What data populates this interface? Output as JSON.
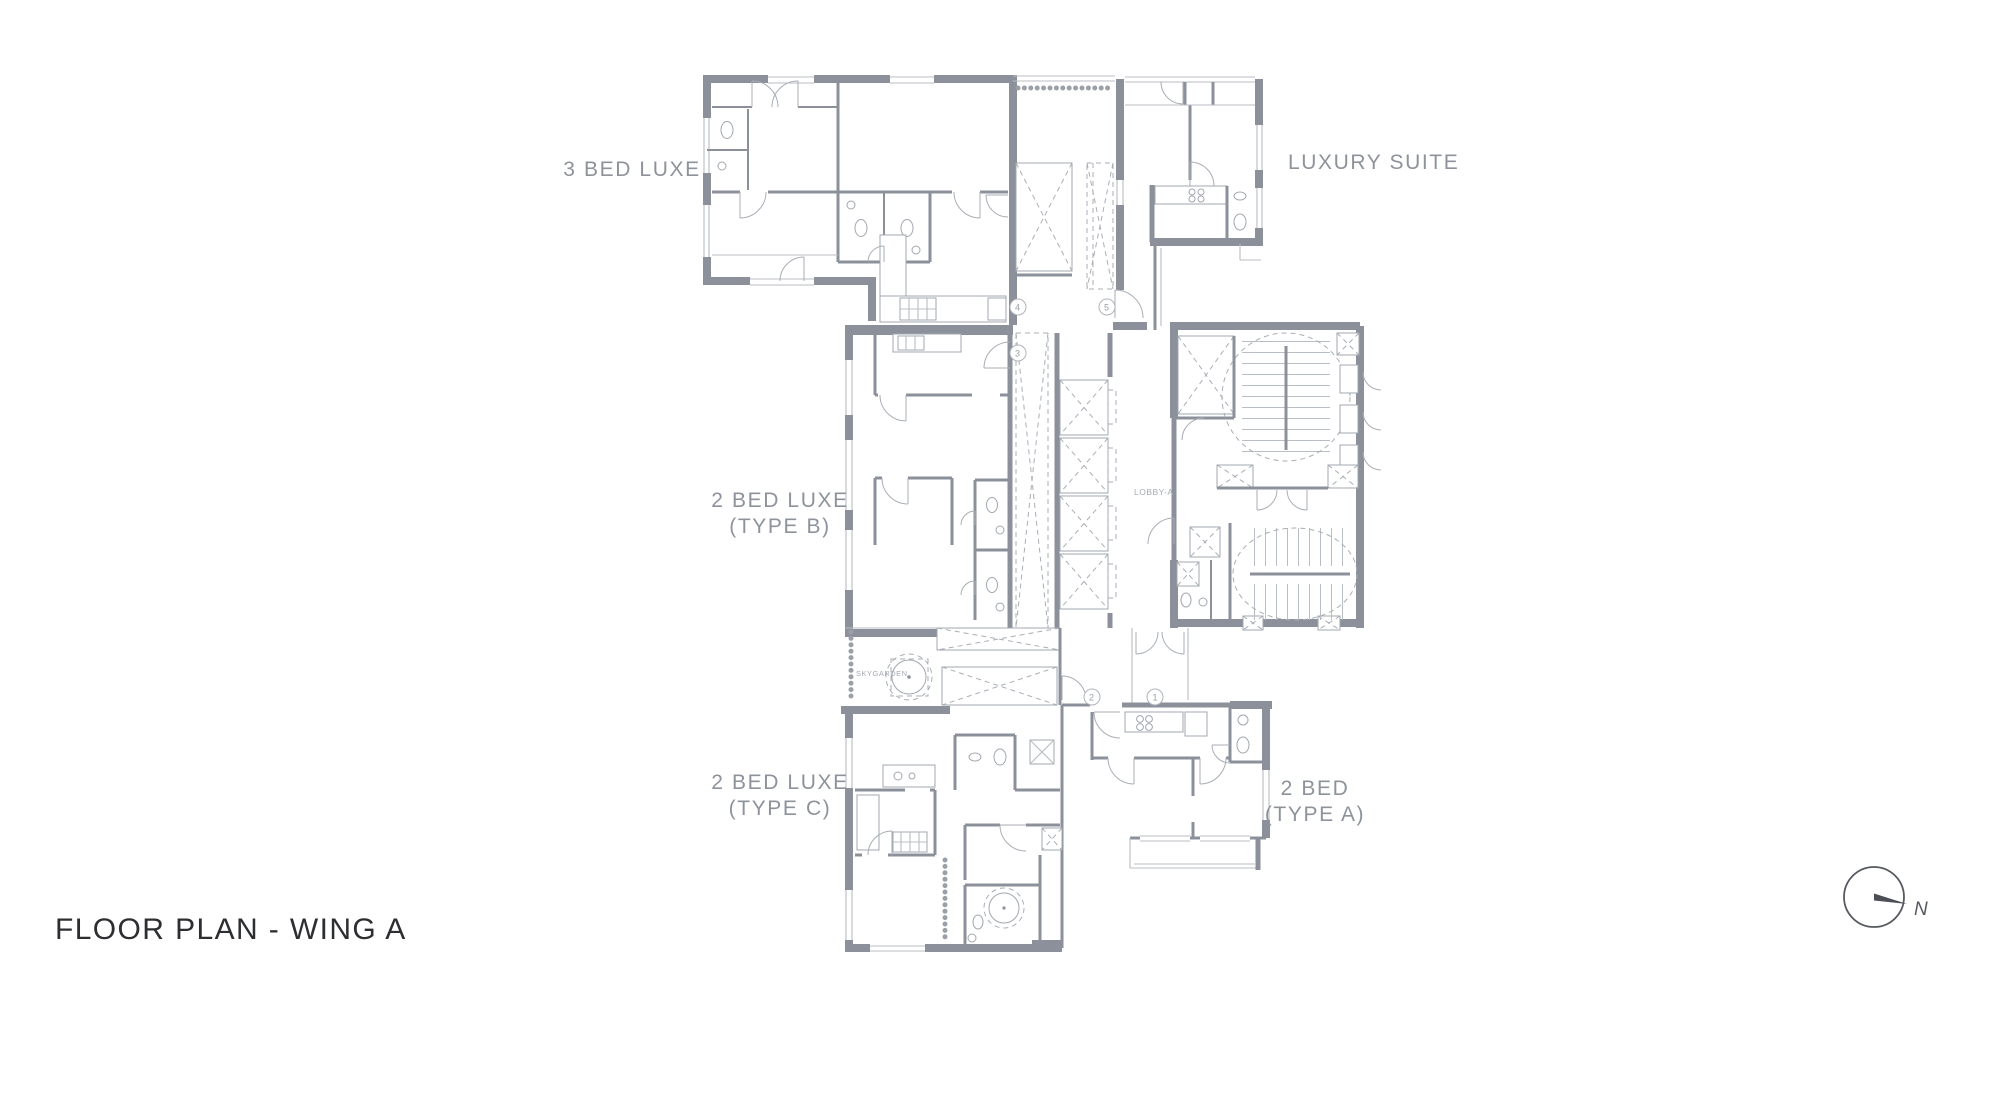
{
  "title": "FLOOR PLAN - WING A",
  "labels": {
    "unit_3bed_luxe": "3 BED LUXE",
    "luxury_suite": "LUXURY SUITE",
    "unit_2bed_b_line1": "2 BED LUXE",
    "unit_2bed_b_line2": "(TYPE B)",
    "unit_2bed_c_line1": "2 BED LUXE",
    "unit_2bed_c_line2": "(TYPE C)",
    "unit_2bed_a_line1": "2 BED",
    "unit_2bed_a_line2": "(TYPE A)",
    "lobby": "LOBBY-A",
    "skygarden": "SKYGARDEN"
  },
  "markers": {
    "m1": "1",
    "m2": "2",
    "m3": "3",
    "m4": "4",
    "m5": "5"
  },
  "compass": {
    "north": "N"
  },
  "colors": {
    "wall": "#8b909a",
    "light_line": "#b9bdc4",
    "label_text": "#8e939b",
    "title_text": "#2d2e31",
    "compass": "#565a60",
    "background": "#ffffff"
  }
}
